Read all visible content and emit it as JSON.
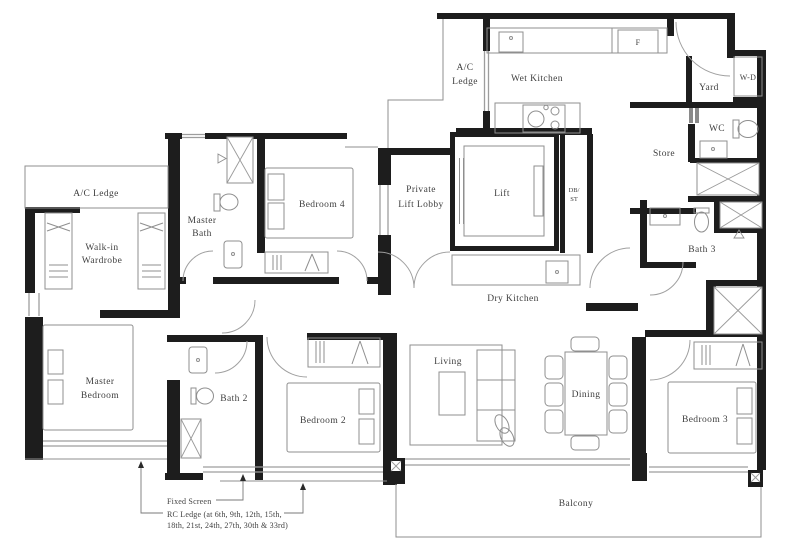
{
  "drawing": {
    "kind": "apartment-floor-plan"
  },
  "colors": {
    "wall": "#1d1d1d",
    "outline": "#8f8f8f",
    "window": "#9d9d9d",
    "label": "#3f3f3f",
    "background": "#ffffff"
  },
  "labels": {
    "ac_ledge_left": "A/C Ledge",
    "walk_in_wardrobe_1": "Walk-in",
    "walk_in_wardrobe_2": "Wardrobe",
    "master_bath_1": "Master",
    "master_bath_2": "Bath",
    "bedroom4": "Bedroom 4",
    "ac_ledge_top_1": "A/C",
    "ac_ledge_top_2": "Ledge",
    "wet_kitchen": "Wet Kitchen",
    "fridge": "F",
    "yard": "Yard",
    "washer_dryer": "W-D",
    "wc": "WC",
    "store": "Store",
    "private_lift_lobby_1": "Private",
    "private_lift_lobby_2": "Lift Lobby",
    "lift": "Lift",
    "db_st_1": "DB/",
    "db_st_2": "ST",
    "bath3": "Bath 3",
    "dry_kitchen": "Dry Kitchen",
    "master_bedroom_1": "Master",
    "master_bedroom_2": "Bedroom",
    "bath2": "Bath 2",
    "bedroom2": "Bedroom 2",
    "living": "Living",
    "dining": "Dining",
    "bedroom3": "Bedroom 3",
    "balcony": "Balcony",
    "fixed_screen": "Fixed Screen",
    "rc_ledge_1": "RC Ledge (at 6th, 9th, 12th, 15th,",
    "rc_ledge_2": "18th, 21st, 24th, 27th, 30th & 33rd)"
  }
}
